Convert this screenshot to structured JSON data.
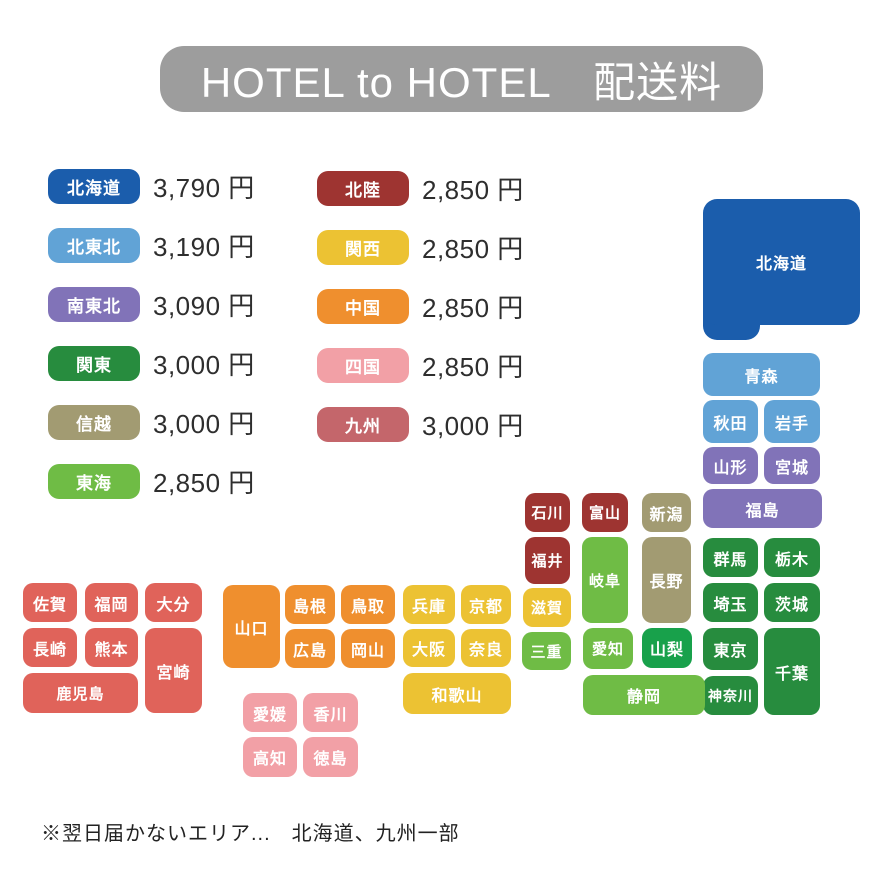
{
  "title": "HOTEL to HOTEL　配送料",
  "note": "※翌日届かないエリア...　北海道、九州一部",
  "colors": {
    "title_bg": "#9d9d9d",
    "hokkaido": "#1b5dac",
    "kita_tohoku": "#61a3d6",
    "minami_tohoku": "#8173b8",
    "kanto": "#278c3e",
    "shinetsu": "#a29b72",
    "tokai": "#6fbc45",
    "yamanashi": "#18a14b",
    "hokuriku": "#9e3431",
    "kansai": "#ecc233",
    "chugoku": "#ef8f2e",
    "shikoku": "#f2a0a6",
    "kyushu": "#e0635a",
    "kyushu_badge": "#c4666b"
  },
  "legend": {
    "left": [
      {
        "label": "北海道",
        "price": "3,790 円",
        "color": "hokkaido"
      },
      {
        "label": "北東北",
        "price": "3,190 円",
        "color": "kita_tohoku"
      },
      {
        "label": "南東北",
        "price": "3,090 円",
        "color": "minami_tohoku"
      },
      {
        "label": "関東",
        "price": "3,000 円",
        "color": "kanto"
      },
      {
        "label": "信越",
        "price": "3,000 円",
        "color": "shinetsu"
      },
      {
        "label": "東海",
        "price": "2,850 円",
        "color": "tokai"
      }
    ],
    "right": [
      {
        "label": "北陸",
        "price": "2,850 円",
        "color": "hokuriku"
      },
      {
        "label": "関西",
        "price": "2,850 円",
        "color": "kansai"
      },
      {
        "label": "中国",
        "price": "2,850 円",
        "color": "chugoku"
      },
      {
        "label": "四国",
        "price": "2,850 円",
        "color": "shikoku"
      },
      {
        "label": "九州",
        "price": "3,000 円",
        "color": "kyushu_badge"
      }
    ]
  },
  "map": {
    "tiles": [
      {
        "label": "",
        "x": 703,
        "y": 250,
        "w": 57,
        "h": 90,
        "c": "hokkaido",
        "big": true
      },
      {
        "label": "北海道",
        "x": 703,
        "y": 199,
        "w": 157,
        "h": 126,
        "c": "hokkaido",
        "big": true
      },
      {
        "label": "青森",
        "x": 703,
        "y": 353,
        "w": 117,
        "h": 43,
        "c": "kita_tohoku"
      },
      {
        "label": "秋田",
        "x": 703,
        "y": 400,
        "w": 55,
        "h": 43,
        "c": "kita_tohoku"
      },
      {
        "label": "岩手",
        "x": 764,
        "y": 400,
        "w": 56,
        "h": 43,
        "c": "kita_tohoku"
      },
      {
        "label": "山形",
        "x": 703,
        "y": 447,
        "w": 55,
        "h": 37,
        "c": "minami_tohoku"
      },
      {
        "label": "宮城",
        "x": 764,
        "y": 447,
        "w": 56,
        "h": 37,
        "c": "minami_tohoku"
      },
      {
        "label": "福島",
        "x": 703,
        "y": 489,
        "w": 119,
        "h": 39,
        "c": "minami_tohoku"
      },
      {
        "label": "群馬",
        "x": 703,
        "y": 538,
        "w": 55,
        "h": 39,
        "c": "kanto"
      },
      {
        "label": "栃木",
        "x": 764,
        "y": 538,
        "w": 56,
        "h": 39,
        "c": "kanto"
      },
      {
        "label": "埼玉",
        "x": 703,
        "y": 583,
        "w": 55,
        "h": 39,
        "c": "kanto"
      },
      {
        "label": "茨城",
        "x": 764,
        "y": 583,
        "w": 56,
        "h": 39,
        "c": "kanto"
      },
      {
        "label": "東京",
        "x": 703,
        "y": 628,
        "w": 55,
        "h": 42,
        "c": "kanto"
      },
      {
        "label": "千葉",
        "x": 764,
        "y": 628,
        "w": 56,
        "h": 87,
        "c": "kanto"
      },
      {
        "label": "神奈川",
        "x": 703,
        "y": 676,
        "w": 55,
        "h": 39,
        "c": "kanto",
        "fs": 14
      },
      {
        "label": "新潟",
        "x": 642,
        "y": 493,
        "w": 49,
        "h": 39,
        "c": "shinetsu"
      },
      {
        "label": "長野",
        "x": 642,
        "y": 537,
        "w": 49,
        "h": 86,
        "c": "shinetsu"
      },
      {
        "label": "山梨",
        "x": 642,
        "y": 628,
        "w": 50,
        "h": 40,
        "c": "yamanashi"
      },
      {
        "label": "石川",
        "x": 525,
        "y": 493,
        "w": 45,
        "h": 39,
        "c": "hokuriku",
        "fs": 15
      },
      {
        "label": "富山",
        "x": 582,
        "y": 493,
        "w": 46,
        "h": 39,
        "c": "hokuriku",
        "fs": 15
      },
      {
        "label": "福井",
        "x": 525,
        "y": 537,
        "w": 45,
        "h": 47,
        "c": "hokuriku",
        "fs": 15
      },
      {
        "label": "岐阜",
        "x": 582,
        "y": 537,
        "w": 46,
        "h": 86,
        "c": "tokai",
        "fs": 15
      },
      {
        "label": "滋賀",
        "x": 523,
        "y": 588,
        "w": 48,
        "h": 39,
        "c": "kansai",
        "fs": 15
      },
      {
        "label": "三重",
        "x": 522,
        "y": 632,
        "w": 49,
        "h": 38,
        "c": "tokai",
        "fs": 15
      },
      {
        "label": "愛知",
        "x": 583,
        "y": 628,
        "w": 50,
        "h": 41,
        "c": "tokai",
        "fs": 15
      },
      {
        "label": "静岡",
        "x": 583,
        "y": 675,
        "w": 122,
        "h": 40,
        "c": "tokai"
      },
      {
        "label": "兵庫",
        "x": 403,
        "y": 585,
        "w": 52,
        "h": 39,
        "c": "kansai"
      },
      {
        "label": "京都",
        "x": 461,
        "y": 585,
        "w": 50,
        "h": 39,
        "c": "kansai"
      },
      {
        "label": "大阪",
        "x": 403,
        "y": 629,
        "w": 52,
        "h": 38,
        "c": "kansai"
      },
      {
        "label": "奈良",
        "x": 461,
        "y": 629,
        "w": 50,
        "h": 38,
        "c": "kansai"
      },
      {
        "label": "和歌山",
        "x": 403,
        "y": 673,
        "w": 108,
        "h": 41,
        "c": "kansai"
      },
      {
        "label": "山口",
        "x": 223,
        "y": 585,
        "w": 57,
        "h": 83,
        "c": "chugoku"
      },
      {
        "label": "島根",
        "x": 285,
        "y": 585,
        "w": 50,
        "h": 39,
        "c": "chugoku"
      },
      {
        "label": "鳥取",
        "x": 341,
        "y": 585,
        "w": 54,
        "h": 39,
        "c": "chugoku"
      },
      {
        "label": "広島",
        "x": 285,
        "y": 629,
        "w": 50,
        "h": 39,
        "c": "chugoku"
      },
      {
        "label": "岡山",
        "x": 341,
        "y": 629,
        "w": 54,
        "h": 39,
        "c": "chugoku"
      },
      {
        "label": "愛媛",
        "x": 243,
        "y": 693,
        "w": 54,
        "h": 39,
        "c": "shikoku"
      },
      {
        "label": "香川",
        "x": 303,
        "y": 693,
        "w": 55,
        "h": 39,
        "c": "shikoku"
      },
      {
        "label": "高知",
        "x": 243,
        "y": 737,
        "w": 54,
        "h": 40,
        "c": "shikoku"
      },
      {
        "label": "徳島",
        "x": 303,
        "y": 737,
        "w": 55,
        "h": 40,
        "c": "shikoku"
      },
      {
        "label": "佐賀",
        "x": 23,
        "y": 583,
        "w": 54,
        "h": 39,
        "c": "kyushu"
      },
      {
        "label": "福岡",
        "x": 85,
        "y": 583,
        "w": 53,
        "h": 39,
        "c": "kyushu"
      },
      {
        "label": "大分",
        "x": 145,
        "y": 583,
        "w": 57,
        "h": 39,
        "c": "kyushu"
      },
      {
        "label": "長崎",
        "x": 23,
        "y": 628,
        "w": 54,
        "h": 39,
        "c": "kyushu"
      },
      {
        "label": "熊本",
        "x": 85,
        "y": 628,
        "w": 53,
        "h": 39,
        "c": "kyushu"
      },
      {
        "label": "宮崎",
        "x": 145,
        "y": 628,
        "w": 57,
        "h": 85,
        "c": "kyushu"
      },
      {
        "label": "鹿児島",
        "x": 23,
        "y": 673,
        "w": 115,
        "h": 40,
        "c": "kyushu",
        "fs": 15
      }
    ]
  }
}
